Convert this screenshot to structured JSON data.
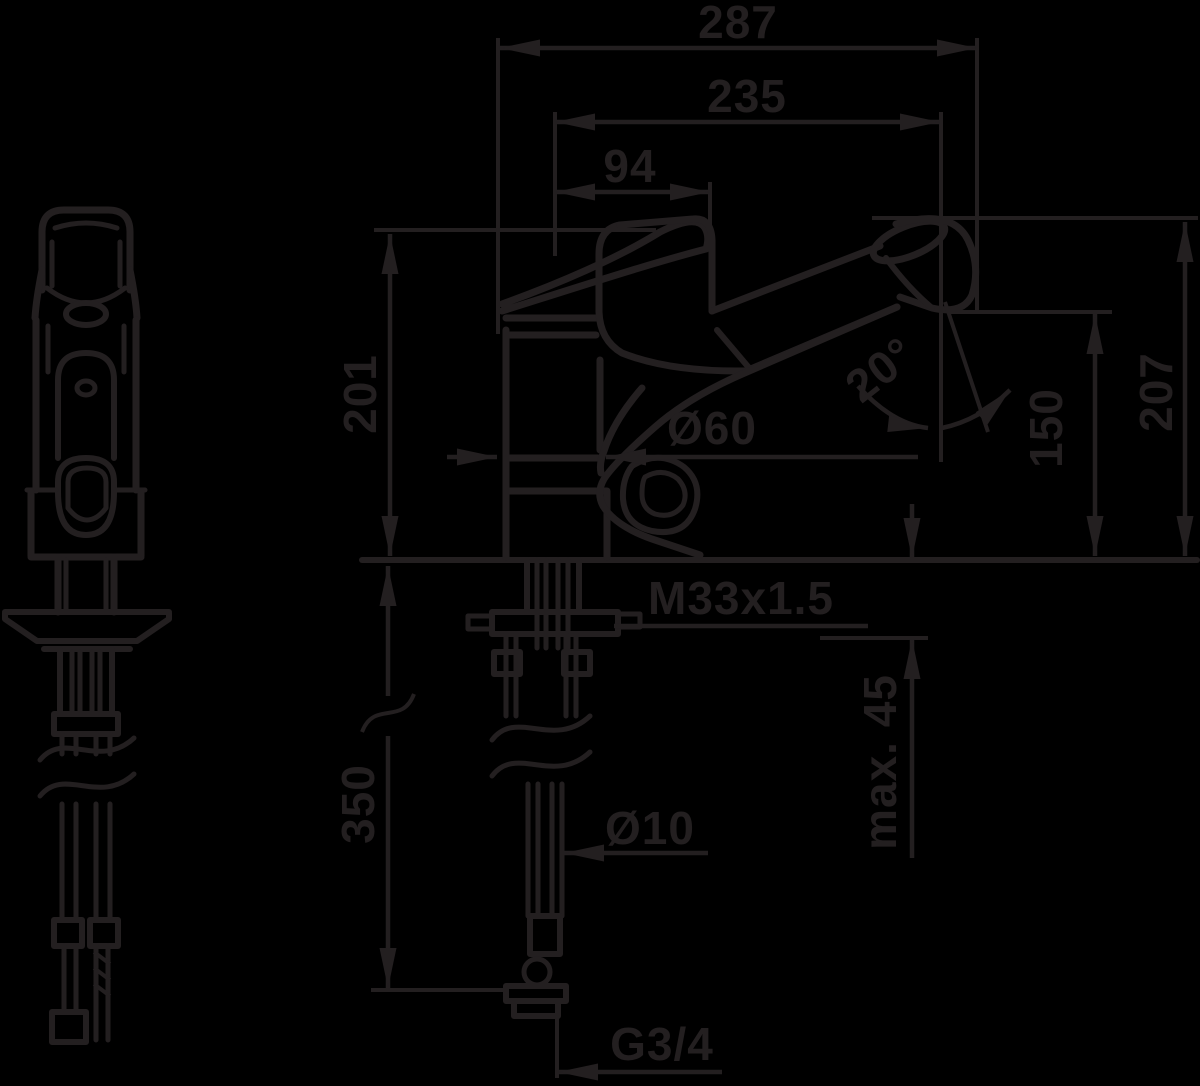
{
  "meta": {
    "background_color": "#000000",
    "ink_color": "#231f20"
  },
  "dimensions": {
    "overall_width": "287",
    "spout_reach": "235",
    "handle_reach": "94",
    "body_height": "201",
    "spout_height": "150",
    "overall_height": "207",
    "base_diameter": "Ø60",
    "swivel_angle": "20°",
    "mounting_thread": "M33x1.5",
    "max_deck_thickness": "max. 45",
    "hose_diameter": "Ø10",
    "hose_length": "350",
    "connection_thread": "G3/4"
  }
}
